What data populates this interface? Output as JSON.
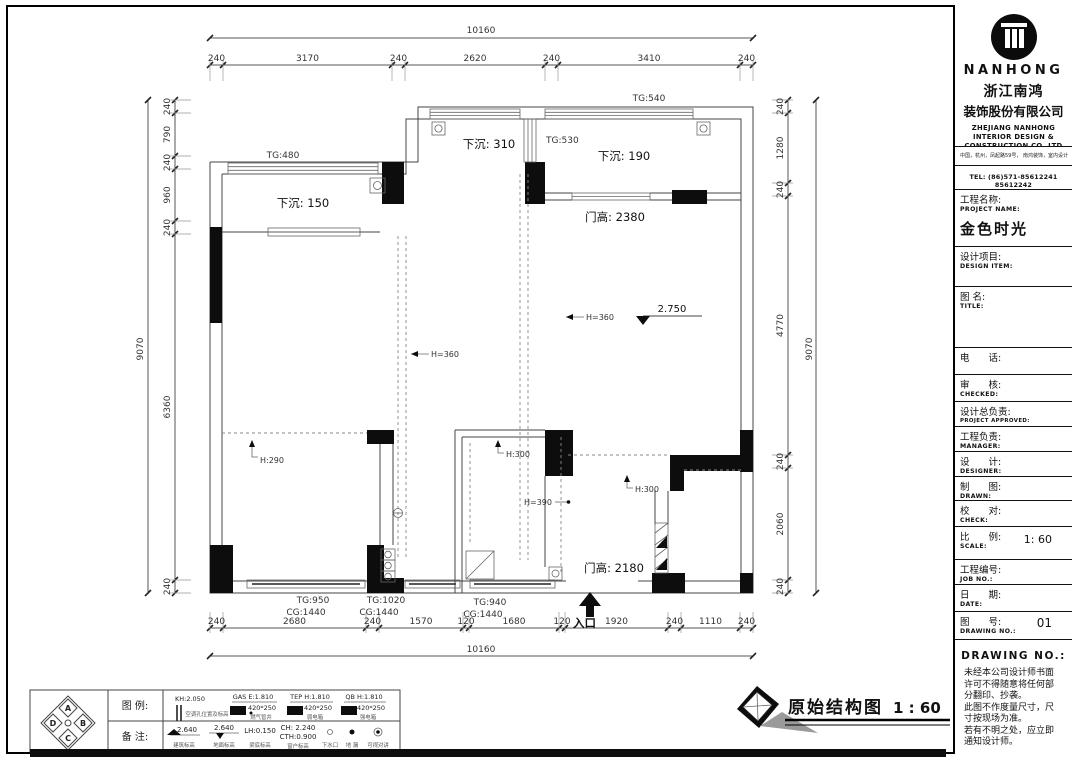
{
  "title_block": {
    "brand": "NANHONG",
    "company_cn_1": "浙江南鸿",
    "company_cn_2": "装饰股份有限公司",
    "company_en_1": "ZHEJIANG NANHONG",
    "company_en_2": "INTERIOR DESIGN &",
    "company_en_3": "CONSTRUCTION CO.,LTD",
    "address": "中国，杭州，凤起路59号， 南鸿装饰，室内设计",
    "tel": "TEL: (86)571-85612241  85612242",
    "project_label_cn": "工程名称:",
    "project_label_en": "PROJECT NAME:",
    "project_name": "金色时光",
    "design_item_cn": "设计项目:",
    "design_item_en": "DESIGN ITEM:",
    "title_cn": "图  名:",
    "title_en": "TITLE:",
    "phone_cn": "电　　话:",
    "checked_cn": "审　　核:",
    "checked_en": "CHECKED:",
    "approved_cn": "设计总负责:",
    "approved_en": "PROJECT APPROVED:",
    "manager_cn": "工程负责:",
    "manager_en": "MANAGER:",
    "designer_cn": "设　　计:",
    "designer_en": "DESIGNER:",
    "drawn_cn": "制　　图:",
    "drawn_en": "DRAWN:",
    "check_cn": "校　　对:",
    "check_en": "CHECK:",
    "scale_cn": "比　　例:",
    "scale_en": "SCALE:",
    "scale_value": "1: 60",
    "job_cn": "工程编号:",
    "job_en": "JOB  NO.:",
    "date_cn": "日　　期:",
    "date_en": "DATE:",
    "dwg_cn": "图　　号:",
    "dwg_en": "DRAWING NO.:",
    "dwg_value": "01",
    "drawing_no_heading": "DRAWING NO.:",
    "notes": [
      "未经本公司设计师书面",
      "许可不得随意将任何部",
      "分翻印、抄袭。",
      "此图不作度量尺寸，尺",
      "寸按现场为准。",
      "若有不明之处，应立即",
      "通知设计师。"
    ]
  },
  "plan": {
    "dims": {
      "top_total": "10160",
      "bottom_total": "10160",
      "left_total": "9070",
      "right_total": "9070",
      "top": [
        "240",
        "3170",
        "240",
        "2620",
        "240",
        "3410",
        "240"
      ],
      "bottom": [
        "240",
        "2680",
        "240",
        "1570",
        "120",
        "1680",
        "120",
        "1920",
        "240",
        "1110",
        "240"
      ],
      "left": [
        "240",
        "790",
        "240",
        "960",
        "240",
        "6360",
        "240"
      ],
      "right": [
        "240",
        "1280",
        "240",
        "4770",
        "240",
        "2060",
        "240"
      ]
    },
    "labels": {
      "tg480": "TG:480",
      "tg530": "TG:530",
      "tg540": "TG:540",
      "sink150": "下沉: 150",
      "sink310": "下沉: 310",
      "sink190": "下沉: 190",
      "door_top": "门高: 2380",
      "door_entry": "门高: 2180",
      "level": "2.750",
      "h360_left": "H=360",
      "h360_right": "H=360",
      "h290": "H:290",
      "h300_bath": "H:300",
      "h390": "H=390",
      "h300_right": "H:300",
      "tg950": "TG:950",
      "cg950": "CG:1440",
      "tg1020": "TG:1020",
      "cg1020": "CG:1440",
      "tg940": "TG:940",
      "cg940": "CG:1440",
      "entrance": "入口"
    }
  },
  "legend": {
    "legend_label": "图 例:",
    "notes_label": "备 注:",
    "compass": [
      "A",
      "B",
      "C",
      "D"
    ],
    "row1": [
      {
        "text": "KH:2.050",
        "sub": "空调孔位置及标高"
      },
      {
        "text": "GAS E:1.810",
        "size": "420*250",
        "sub": "燃气管井"
      },
      {
        "text": "TEP H:1.810",
        "size": "420*250",
        "sub": "弱电箱"
      },
      {
        "text": "QB H:1.810",
        "size": "420*250",
        "sub": "强电箱"
      }
    ],
    "row2": [
      {
        "text": "2.640",
        "sub": "建筑标高"
      },
      {
        "text": "2.640",
        "sub": "地面标高"
      },
      {
        "text": "LH:0.150",
        "sub": "梁底标高"
      },
      {
        "text": "CH: 2.240",
        "text2": "CTH:0.900",
        "sub": "窗户标高"
      },
      {
        "sub": "下水口"
      },
      {
        "sub": "地 漏"
      },
      {
        "sub": "可视对讲"
      }
    ]
  },
  "footer": {
    "drawing_title": "原始结构图",
    "drawing_scale": "1 : 60"
  }
}
